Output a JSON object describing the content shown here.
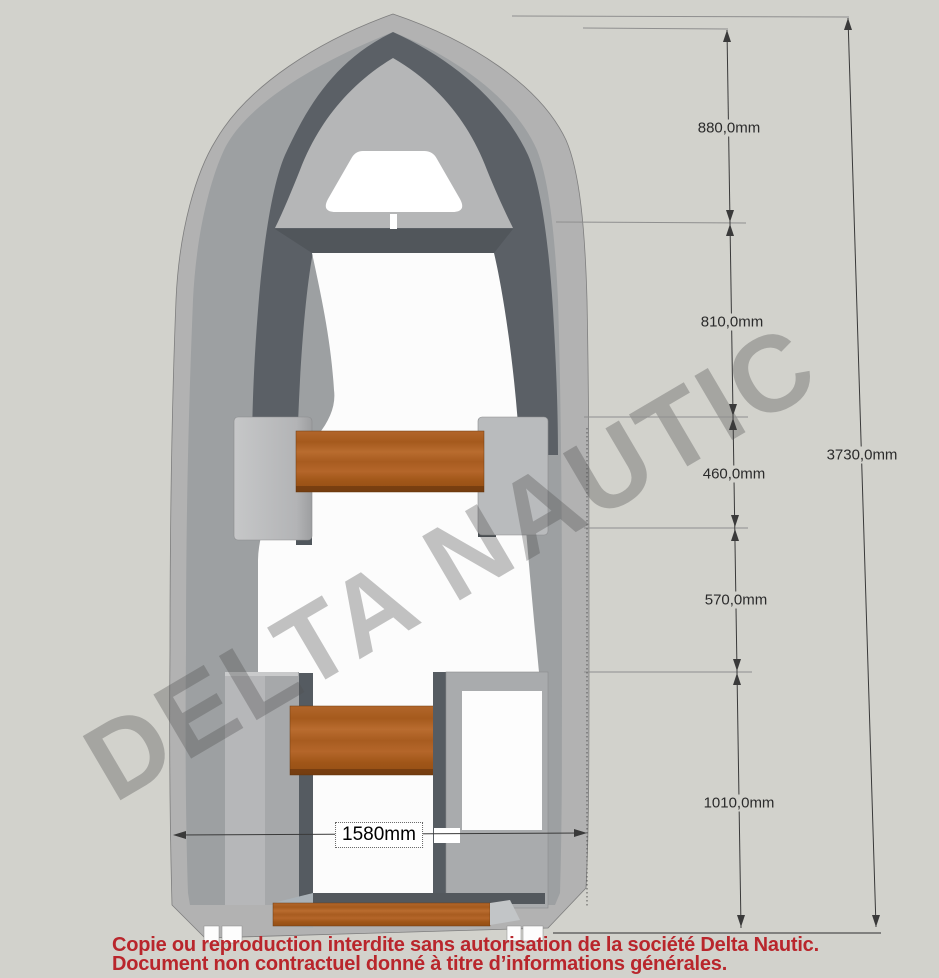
{
  "watermark": {
    "text": "DELTA NAUTIC"
  },
  "dimensions": {
    "segments": [
      {
        "label": "880,0mm"
      },
      {
        "label": "810,0mm"
      },
      {
        "label": "460,0mm"
      },
      {
        "label": "570,0mm"
      },
      {
        "label": "1010,0mm"
      }
    ],
    "overall_length_label": "3730,0mm",
    "beam_label": "1580mm"
  },
  "footer": {
    "line1": "Copie ou reproduction interdite sans autorisation de la société Delta Nautic.",
    "line2": "Document non contractuel donné à titre d’informations générales."
  },
  "colors": {
    "background": "#d2d2cc",
    "hull": "#b2b2b2",
    "hull_inner_band": "#9da0a2",
    "bow_dark_band": "#5b6066",
    "deck": "#b5b6b7",
    "cockpit_floor": "#fcfcfc",
    "seat_wood": "#ad5f22",
    "dimension_line": "#3a3a3a",
    "footer_text": "#b9262c",
    "watermark_gray": "#8a8a8a"
  }
}
